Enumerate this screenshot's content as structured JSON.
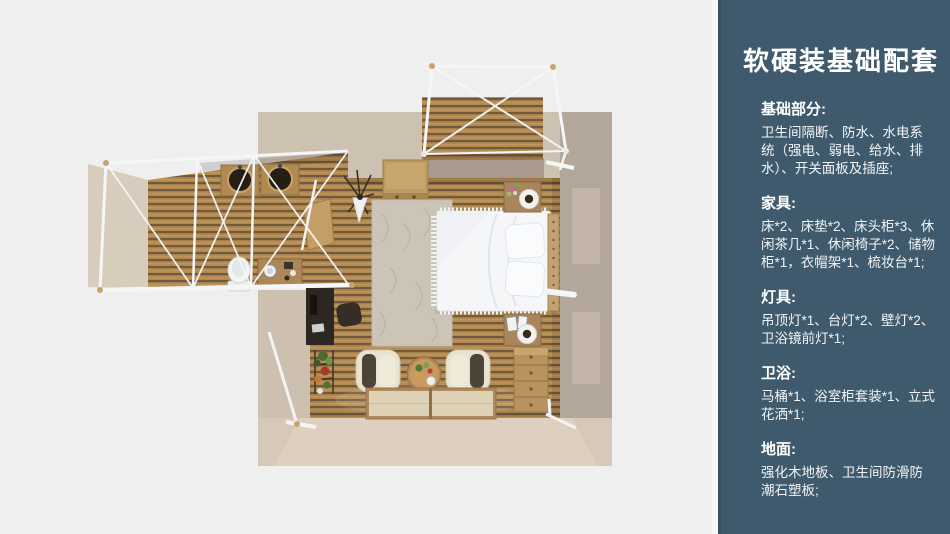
{
  "sidebar": {
    "title": "软硬装基础配套",
    "background": "#3e5a6c",
    "text_color": "#ffffff",
    "sections": [
      {
        "heading": "基础部分:",
        "body": "卫生间隔断、防水、水电系统（强电、弱电、给水、排水）、开关面板及插座;"
      },
      {
        "heading": "家具:",
        "body": "床*2、床垫*2、床头柜*3、休闲茶几*1、休闲椅子*2、储物柜*1，衣帽架*1、梳妆台*1;"
      },
      {
        "heading": "灯具:",
        "body": "吊顶灯*1、台灯*2、壁灯*2、卫浴镜前灯*1;"
      },
      {
        "heading": "卫浴:",
        "body": "马桶*1、浴室柜套装*1、立式花洒*1;"
      },
      {
        "heading": "地面:",
        "body": "强化木地板、卫生间防滑防潮石塑板;"
      }
    ]
  },
  "floorplan": {
    "view": "top-down 3D render",
    "rooms": [
      "bedroom",
      "bathroom-wing",
      "balcony-deck"
    ],
    "furniture_visible": [
      "bed",
      "pillows",
      "nightstands-with-lamps",
      "wardrobe-cabinet",
      "dresser",
      "armchairs",
      "round-coffee-table",
      "floor-mats",
      "rug",
      "desk",
      "desk-chair",
      "plant-stand",
      "coat-rack",
      "toilet",
      "twin-basin-vanity",
      "bathroom-cabinet",
      "wall-shelf"
    ],
    "colors": {
      "page_background": "#efefef",
      "wood_floor": "#b3894f",
      "wood_floor_dark": "#6f5a3e",
      "wall_top": "#cdc1b2",
      "wall_right": "#b3a69b",
      "wall_bottom": "#d6c9ba",
      "frame_white": "#f5f6f7",
      "bed_white": "#f5f6f8"
    }
  }
}
